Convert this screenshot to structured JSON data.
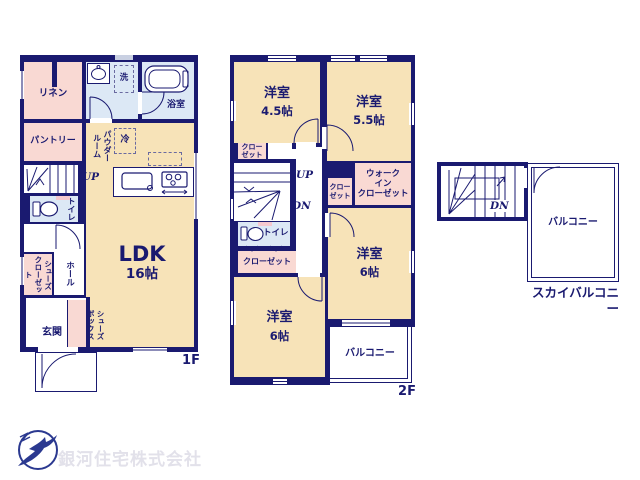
{
  "palette": {
    "wall": "#1A1A70",
    "room_cream": "#F7E3B8",
    "room_pink": "#F9D9D3",
    "room_blue": "#DCE8F5",
    "company_text": "#E2E1EA",
    "logo_blue": "#2B3990"
  },
  "floor1": {
    "floor_label": "1F",
    "ldk": {
      "name": "LDK",
      "size": "16帖"
    },
    "linen": "リネン",
    "pantry": "パントリー",
    "powder_room": "パウダー\nルーム",
    "wash": "洗",
    "fridge": "冷",
    "bathroom": "浴室",
    "toilet": "トイレ",
    "hall": "ホール",
    "shoes_closet": "シューズ\nクローゼット",
    "shoe_box": "シューズ\nボックス",
    "entrance": "玄関",
    "stairs_up": "UP"
  },
  "floor2": {
    "floor_label": "2F",
    "bedroom_45": {
      "name": "洋室",
      "size": "4.5帖"
    },
    "bedroom_55": {
      "name": "洋室",
      "size": "5.5帖"
    },
    "bedroom_6a": {
      "name": "洋室",
      "size": "6帖"
    },
    "bedroom_6b": {
      "name": "洋室",
      "size": "6帖"
    },
    "closet_a": "クロー\nゼット",
    "closet_b": "クロー\nゼット",
    "closet_c": "クローゼット",
    "walk_in_closet": "ウォーク\nイン\nクローゼット",
    "toilet": "トイレ",
    "balcony": "バルコニー",
    "stairs_up": "UP",
    "stairs_down": "DN"
  },
  "roof": {
    "label": "スカイバルコニー",
    "balcony": "バルコニー",
    "stairs_down": "DN"
  },
  "footer": {
    "company_name": "銀河住宅株式会社"
  }
}
